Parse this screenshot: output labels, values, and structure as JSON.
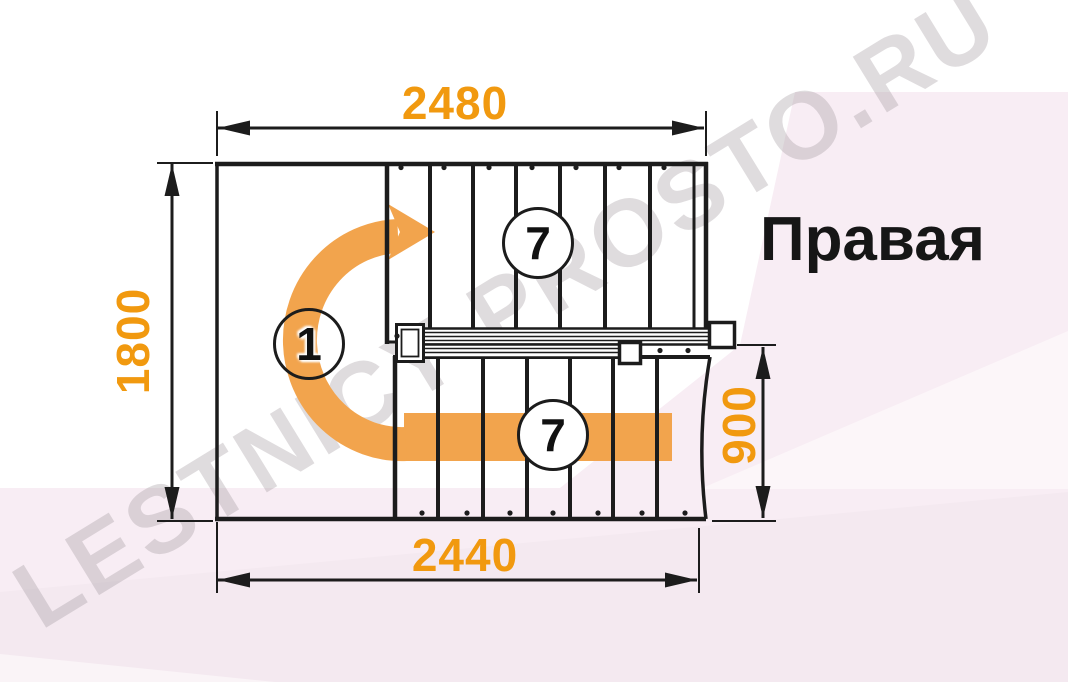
{
  "diagram": {
    "type_label": "Правая",
    "dimensions_mm": {
      "top_width": "2480",
      "bottom_width": "2440",
      "left_depth": "1800",
      "right_flight_width": "900"
    },
    "step_labels": {
      "upper_flight": "7",
      "lower_flight": "7",
      "winder": "1"
    },
    "watermark": "LESTNICY-PROSTO.RU",
    "colors": {
      "dimension_text": "#f1990f",
      "arrow": "#f2a44d",
      "linework": "#1c1c1c",
      "background_tint": "#f8edf4"
    }
  }
}
